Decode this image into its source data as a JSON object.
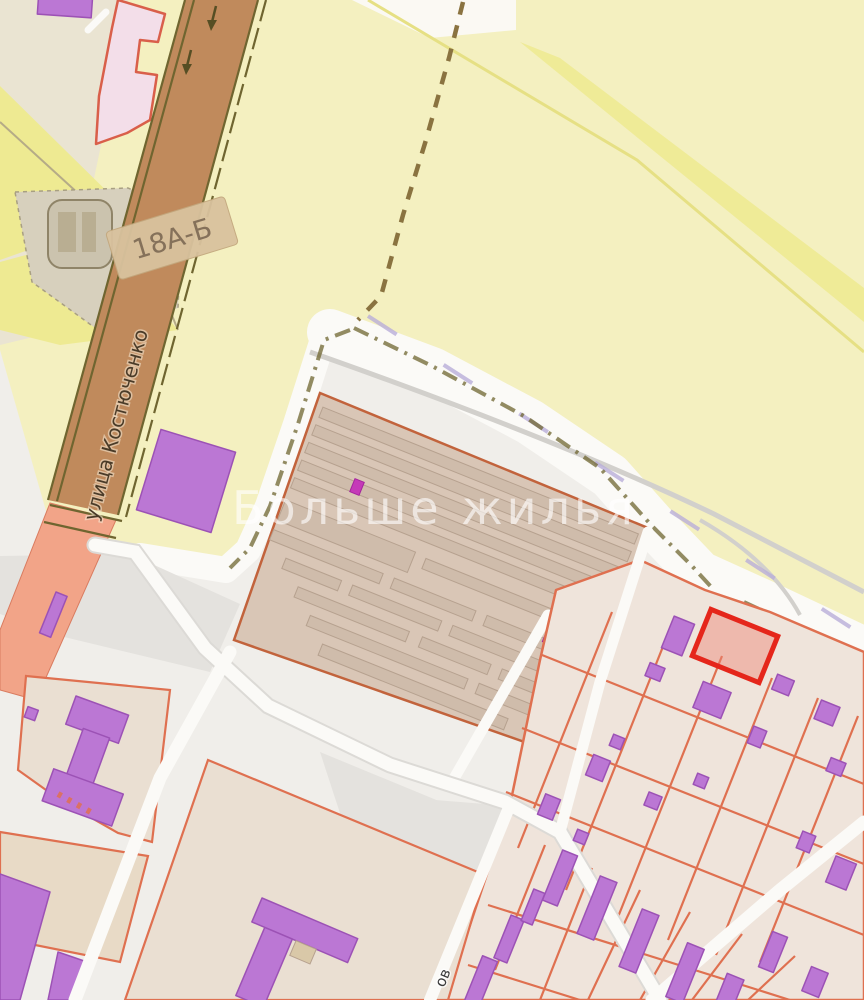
{
  "map": {
    "watermark": "Больше жилья",
    "street_label": "улица Костюченко",
    "building_label": "18А-Б",
    "partial_street_label": "ов"
  },
  "colors": {
    "base_light": "#f0eeea",
    "field_yellow": "#f4f0c0",
    "field_yellow_bright": "#eeea92",
    "gray_area": "#e4e2de",
    "khaki_area": "#d7d0bd",
    "road_brown": "#c08a5c",
    "road_salmon": "#f2a488",
    "road_white": "#fbfaf7",
    "olive_line": "#6f6530",
    "path_dash": "#8a7340",
    "boundary_lavender": "#b9aed8",
    "garage_fill": "#d9c6b6",
    "garage_row": "#cfbcab",
    "parcel_line_orange": "#df7050",
    "parcel_fill": "#efe4db",
    "building_purple": "#bb77d4",
    "building_purple_border": "#9c52b5",
    "building_magenta": "#c53ab8",
    "highlight_red": "#e5261b",
    "highlight_fill": "#ee8576",
    "pink_building": "#f3dee9",
    "pink_border": "#d95f4a",
    "tan_label_bg": "#d9c29e",
    "label_text": "#85715a",
    "watermark_color": "rgba(255,255,255,0.62)"
  }
}
